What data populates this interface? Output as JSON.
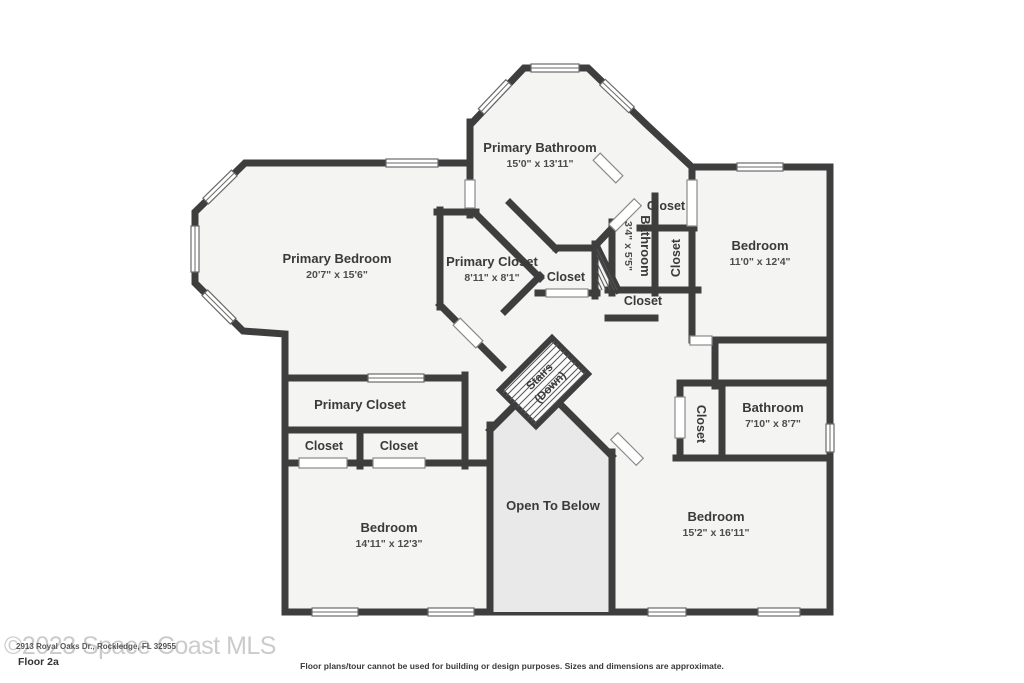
{
  "labels": {
    "primary_bathroom": {
      "name": "Primary Bathroom",
      "dims": "15'0\" x 13'11\""
    },
    "primary_bedroom": {
      "name": "Primary Bedroom",
      "dims": "20'7\" x 15'6\""
    },
    "primary_closet_upper": {
      "name": "Primary Closet",
      "dims": "8'11\" x 8'1\""
    },
    "closet_top": {
      "name": "Closet"
    },
    "bathroom_small": {
      "name": "Bathroom",
      "dims": "3'4\" x 5'5\""
    },
    "closet_vertical": {
      "name": "Closet"
    },
    "bedroom_right": {
      "name": "Bedroom",
      "dims": "11'0\" x 12'4\""
    },
    "closet_center": {
      "name": "Closet"
    },
    "closet_mid": {
      "name": "Closet"
    },
    "stairs": {
      "line1": "Stairs",
      "line2": "(Down)"
    },
    "primary_closet_lower": {
      "name": "Primary Closet"
    },
    "closet_a": {
      "name": "Closet"
    },
    "closet_b": {
      "name": "Closet"
    },
    "closet_bath": {
      "name": "Closet"
    },
    "bathroom_right": {
      "name": "Bathroom",
      "dims": "7'10\" x 8'7\""
    },
    "open_to_below": {
      "name": "Open To Below"
    },
    "bedroom_bottom_left": {
      "name": "Bedroom",
      "dims": "14'11\" x 12'3\""
    },
    "bedroom_bottom_right": {
      "name": "Bedroom",
      "dims": "15'2\" x 16'11\""
    }
  },
  "footer": {
    "watermark": "©2023 Space Coast MLS",
    "address": "2913 Royal Oaks Dr., Rockledge, FL 32955",
    "floor_label": "Floor 2a",
    "disclaimer": "Floor plans/tour cannot be used for building or design purposes. Sizes and dimensions are approximate."
  },
  "colors": {
    "wall": "#3e3e3e",
    "floor": "#f4f4f3",
    "shaft": "#e9e9e9"
  }
}
